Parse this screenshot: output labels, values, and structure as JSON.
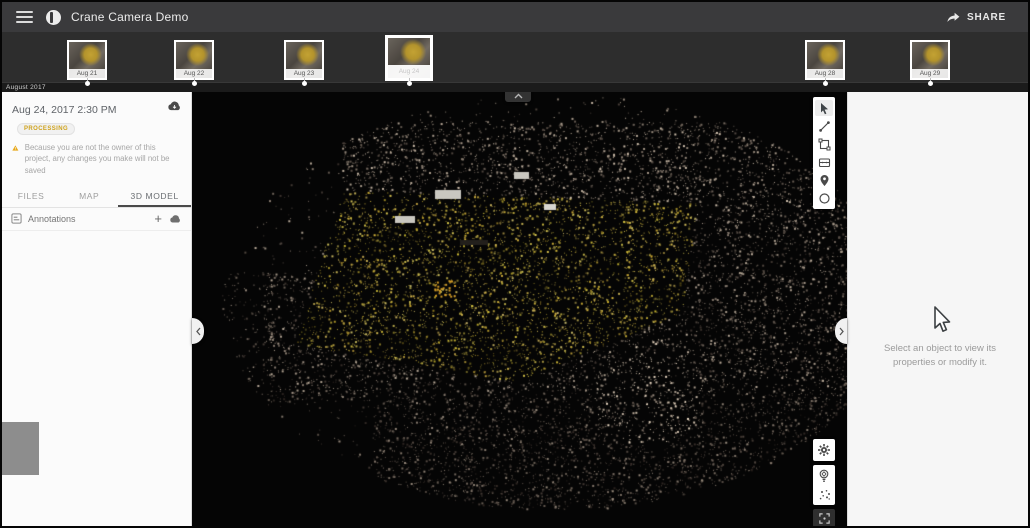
{
  "app": {
    "title": "Crane Camera Demo",
    "share_label": "SHARE"
  },
  "timeline": {
    "month_label": "August 2017",
    "thumbnails": [
      {
        "date": "Aug 21",
        "selected": false
      },
      {
        "date": "Aug 22",
        "selected": false
      },
      {
        "date": "Aug 23",
        "selected": false
      },
      {
        "date": "Aug 24",
        "selected": true
      },
      {
        "date": "Aug 28",
        "selected": false
      },
      {
        "date": "Aug 29",
        "selected": false
      }
    ]
  },
  "left_panel": {
    "dataset_date": "Aug 24, 2017 2:30 PM",
    "status_badge": "Processing",
    "warning": "Because you are not the owner of this project, any changes you make will not be saved",
    "tabs": [
      {
        "label": "FILES",
        "active": false
      },
      {
        "label": "MAP",
        "active": false
      },
      {
        "label": "3D MODEL",
        "active": true
      }
    ],
    "annotations": {
      "label": "Annotations",
      "add_label": "+"
    }
  },
  "right_panel": {
    "empty_state": "Select an object to view its properties or modify it."
  },
  "viewport": {
    "scene": "Aerial 3D point cloud of a construction excavation site with yellow clay pit"
  },
  "colors": {
    "top_bar": "#3a3a3c",
    "timeline_strip": "#2d2d2d",
    "panel_bg": "#fbfbfb",
    "accent_warning": "#e8a91c",
    "site_yellow": "#b3932c"
  }
}
